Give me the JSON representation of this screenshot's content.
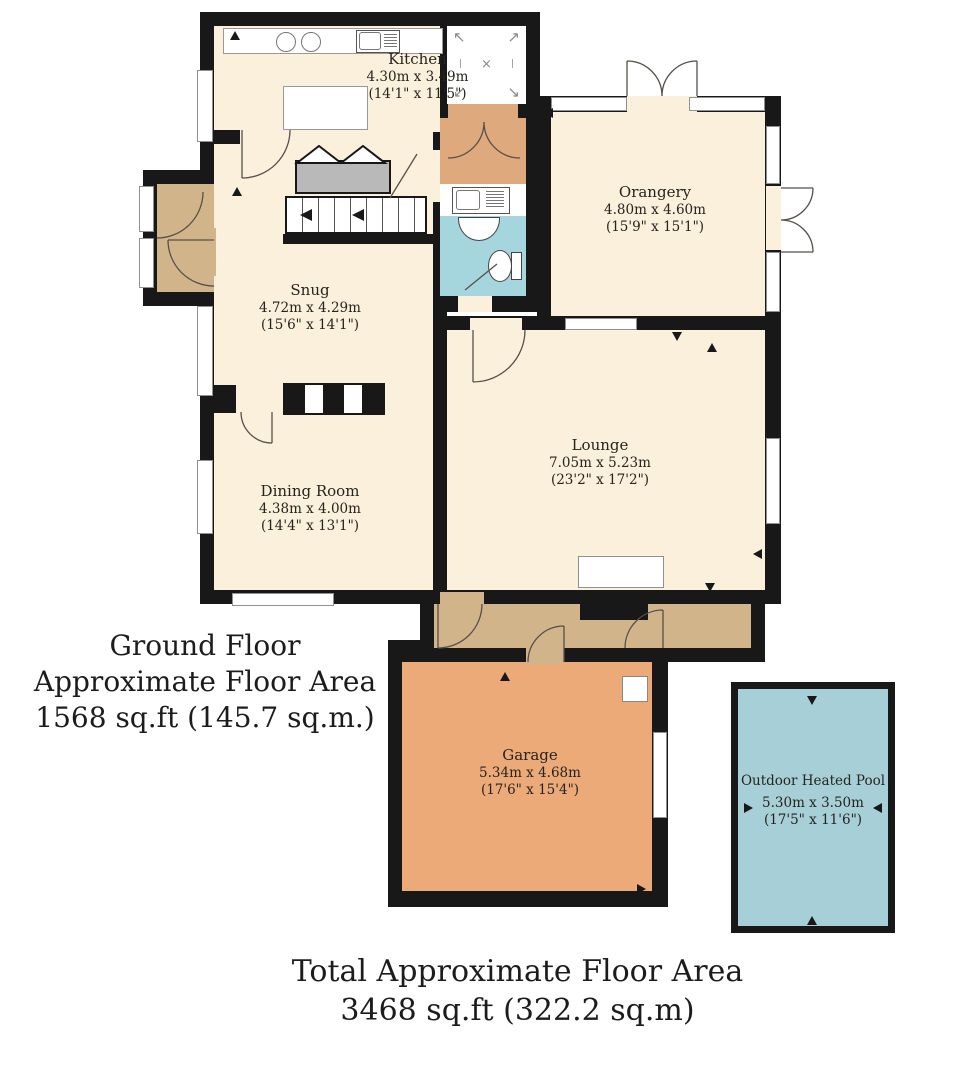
{
  "rooms": {
    "kitchen": {
      "name": "Kitchen",
      "metric": "4.30m x 3.49m",
      "imperial": "(14'1\" x 11'5\")"
    },
    "orangery": {
      "name": "Orangery",
      "metric": "4.80m x 4.60m",
      "imperial": "(15'9\" x 15'1\")"
    },
    "snug": {
      "name": "Snug",
      "metric": "4.72m x 4.29m",
      "imperial": "(15'6\" x 14'1\")"
    },
    "lounge": {
      "name": "Lounge",
      "metric": "7.05m x 5.23m",
      "imperial": "(23'2\" x 17'2\")"
    },
    "dining_room": {
      "name": "Dining Room",
      "metric": "4.38m x 4.00m",
      "imperial": "(14'4\" x 13'1\")"
    },
    "garage": {
      "name": "Garage",
      "metric": "5.34m x 4.68m",
      "imperial": "(17'6\" x 15'4\")"
    },
    "pool": {
      "name": "Outdoor Heated Pool",
      "metric": "5.30m x 3.50m",
      "imperial": "(17'5\" x 11'6\")"
    }
  },
  "annotations": {
    "ground_floor_line1": "Ground Floor",
    "ground_floor_line2": "Approximate Floor Area",
    "ground_floor_line3": "1568 sq.ft (145.7 sq.m.)",
    "total_line1": "Total Approximate Floor Area",
    "total_line2": "3468 sq.ft (322.2 sq.m)"
  },
  "symbols": {
    "arrow_nw": "↖",
    "arrow_ne": "↗",
    "arrow_sw": "↙",
    "arrow_se": "↘",
    "cross": "×",
    "tick": "|"
  },
  "colors": {
    "wall": "#181818",
    "room_cream": "#faf0dc",
    "hall_tan": "#d2b48b",
    "garage_salmon": "#ecaa79",
    "vestibule_salmon": "#dfa97e",
    "wc_cyan": "#a5d6de",
    "pool_cyan": "#a7cfd7",
    "stairs_grey": "#b9b9b9"
  }
}
